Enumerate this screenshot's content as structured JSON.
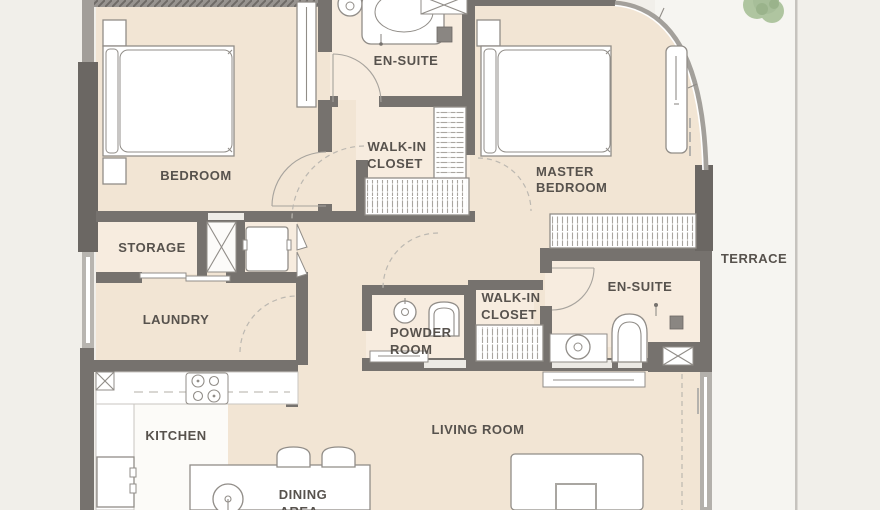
{
  "title": "Apartment floor plan",
  "colors": {
    "bg": "#f1efea",
    "terrace": "#f6f5f1",
    "floor": "#f2e5d4",
    "floor_wet": "#f7ecdf",
    "kitchen_floor": "#fcfbf8",
    "wall": "#76726e",
    "wall_dark": "#6b6763",
    "wall_light": "#a29e99",
    "glass": "#b5b1ac",
    "line": "#918d88",
    "text": "#57524d",
    "tree": "#a3bd93",
    "tree_dark": "#8aa87a",
    "terrace_edge": "#c6c3be"
  },
  "rooms": {
    "bedroom": {
      "label": "BEDROOM"
    },
    "ensuite_top": {
      "label": "EN-SUITE"
    },
    "walk_in_closet_top": {
      "line1": "WALK-IN",
      "line2": "CLOSET"
    },
    "master_bedroom": {
      "line1": "MASTER",
      "line2": "BEDROOM"
    },
    "storage": {
      "label": "STORAGE"
    },
    "terrace": {
      "label": "TERRACE"
    },
    "laundry": {
      "label": "LAUNDRY"
    },
    "ensuite_right": {
      "label": "EN-SUITE"
    },
    "walk_in_closet_lower": {
      "line1": "WALK-IN",
      "line2": "CLOSET"
    },
    "powder_room": {
      "line1": "POWDER",
      "line2": "ROOM"
    },
    "kitchen": {
      "label": "KITCHEN"
    },
    "living_room": {
      "label": "LIVING ROOM"
    },
    "dining_area": {
      "line1": "DINING",
      "line2": "AREA"
    }
  }
}
